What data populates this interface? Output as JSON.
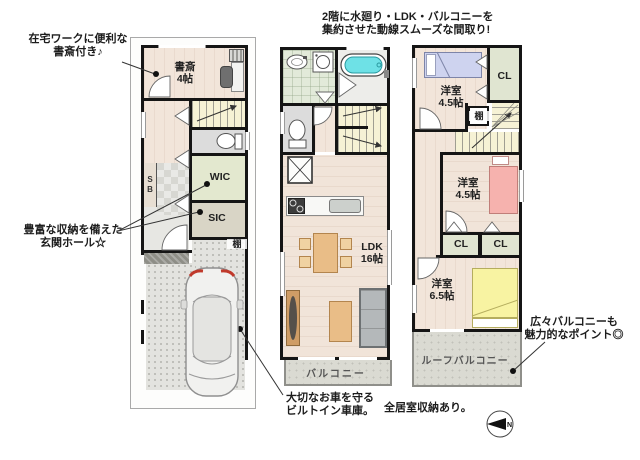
{
  "palette": {
    "wall": "#151515",
    "wood_floor": "#f2e5da",
    "stairs": "#f6f2d5",
    "washroom_floor": "#e2ead9",
    "closet_floor": "#e0e5d1",
    "balcony": "#dadad2",
    "bathtub": "#6ee1e6",
    "bed_purple": "#ced3ef",
    "bed_pink": "#f6b2ae",
    "bed_yellow": "#f8f3a2",
    "furniture_tan": "#e9bd87",
    "sofa_gray": "#b4b8ba",
    "tail_light_red": "#c0392b"
  },
  "annotations": {
    "study_line1": "在宅ワークに便利な",
    "study_line2": "書斎付き♪",
    "storage_line1": "豊富な収納を備えた",
    "storage_line2": "玄関ホール☆",
    "flow_line1": "2階に水廻り・LDK・バルコニーを",
    "flow_line2": "集約させた動線スムーズな間取り!",
    "garage_line1": "大切なお車を守る",
    "garage_line2": "ビルトイン車庫。",
    "balcony_line1": "広々バルコニーも",
    "balcony_line2": "魅力的なポイント◎",
    "all_rooms_note": "全居室収納あり。"
  },
  "floor1": {
    "study_name": "書斎",
    "study_size": "4帖",
    "wic_label": "WIC",
    "sic_label": "SIC",
    "shoe_box_label": "SB",
    "shelf_label": "棚"
  },
  "floor2": {
    "ldk_name": "LDK",
    "ldk_size": "16帖",
    "balcony_label": "バルコニー"
  },
  "floor3": {
    "bedroom1_name": "洋室",
    "bedroom1_size": "4.5帖",
    "bedroom2_name": "洋室",
    "bedroom2_size": "4.5帖",
    "bedroom3_name": "洋室",
    "bedroom3_size": "6.5帖",
    "closet1_label": "CL",
    "closet2_label": "CL",
    "closet3_label": "CL",
    "shelf_label": "棚",
    "roof_balcony_label": "ルーフバルコニー"
  },
  "compass": {
    "north_label": "N"
  }
}
